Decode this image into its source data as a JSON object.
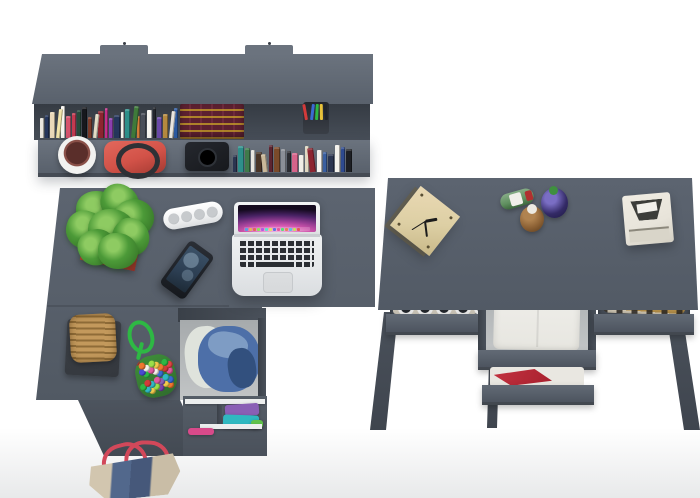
{
  "palette": {
    "background": "#ffffff",
    "floor_shadow": "#e8e9ea",
    "furniture": "#59616c",
    "furniture_light": "#6b737e",
    "furniture_dark": "#474e58",
    "drawer_front": "#5a626d",
    "leg": "#4a515b",
    "white_shelf": "#eceeee",
    "plant_green": "#4c9a38",
    "plant_green_dark": "#2f6b22",
    "planter_red": "#b53a2e",
    "pot_white": "#f2f2f0",
    "pot_plant": "#5a2e2a",
    "handbag_red": "#d25248",
    "handbag_strap": "#2e3136",
    "camera_black": "#17191d",
    "classic_book": "#5c2030",
    "classic_book_gold": "#c9a227",
    "laptop_body": "#e7e9eb",
    "laptop_key": "#2b2e33",
    "laptop_trackpad": "#d7d9db",
    "screen_dark": "#140a1e",
    "phone_body": "#15181d",
    "phone_screen": "#2c3e52",
    "speaker_white": "#f1f2f3",
    "basket_tan": "#c3995c",
    "basket_tan_dark": "#8f6c38",
    "tray_dark": "#34383e",
    "cord_green": "#2eb844",
    "denim_blue": "#4d6fa8",
    "denim_light": "#7e9cc4",
    "denim_dark": "#32507e",
    "cloth_white": "#dfe3dc",
    "clock_wood": "#ddcfa4",
    "bottle_green": "#5f8f5f",
    "bottle_amber": "#8a5f33",
    "bottle_blue": "#332a66",
    "white_box": "#e8e4da",
    "pants_white": "#efeeea",
    "red_cloth": "#a8202e",
    "plaid_tan": "#c0984e",
    "tote_beige": "#c9bda6",
    "tote_denim": "#52688c",
    "tote_strap_red": "#d2485a",
    "tee_black": "#1b1d21",
    "clothes_purple": "#8a5fb5",
    "clothes_teal": "#2fb8c0",
    "clothes_green": "#5fc14a",
    "clothes_pink": "#d84a8a"
  },
  "books": {
    "top_row": [
      "#e9e6df",
      "#25365c",
      "#ead9b9",
      "#f2e4a9",
      "#f7f5f0",
      "#d6536d",
      "#c23a50",
      "#274a3a",
      "#16181d",
      "#7a3b2a",
      "#e3dcc6",
      "#8c2430",
      "#c22f8a",
      "#8a3fae",
      "#25365c",
      "#f4f2ec",
      "#2e8f8a",
      "#3f7a3a",
      "#d07c3a",
      "#494e58",
      "#f7f5f0",
      "#23262c",
      "#6a49a8",
      "#b5893f",
      "#e9e6df",
      "#2c5aa0"
    ],
    "ledge_row": [
      "#2b3550",
      "#2e8f8a",
      "#3f7a4a",
      "#e8e6e0",
      "#4a3527",
      "#c9b89a",
      "#5c2430",
      "#7a4a2a",
      "#8a8f98",
      "#2b2d33",
      "#d6648a",
      "#f0ede6",
      "#e0d8c2",
      "#8c2430",
      "#f7f5f0",
      "#3a5fa0",
      "#2b3550",
      "#f4f2ec",
      "#2e4a8f",
      "#1d1f24"
    ]
  },
  "pens": [
    "#d23a3a",
    "#3a6bd2",
    "#2eb844",
    "#e8c23a",
    "#20242a"
  ],
  "pompoms": [
    "#e04444",
    "#3a6bd2",
    "#f2c94c",
    "#e05aa0",
    "#7a3fae",
    "#2eb844",
    "#f07830",
    "#f4f2ec",
    "#30b8c4",
    "#d23a3a",
    "#9adf4a",
    "#4a4ad2",
    "#f2c94c",
    "#e05aa0",
    "#2eb844",
    "#f07830",
    "#30b8c4",
    "#e04444",
    "#8a5fb5",
    "#f4f2ec",
    "#3a6bd2",
    "#f2c94c",
    "#d23a3a",
    "#2eb844",
    "#e05aa0",
    "#f07830",
    "#30b8c4",
    "#9adf4a"
  ],
  "dock_icons": [
    "#5aa0e8",
    "#e8b85a",
    "#e86a5a",
    "#8ae85a",
    "#b85ae8",
    "#5ae8d2",
    "#e8e85a",
    "#5a78e8",
    "#e85aa0",
    "#5ae87a",
    "#e8885a",
    "#5ac8e8",
    "#c8e85a",
    "#e85a5a"
  ],
  "objects": {
    "wall_shelf": "Wall shelf with books and accessories",
    "classic_books": "Antique red-and-gold book set",
    "pencil_cup": "Pencil cup",
    "flower_pot": "White flower pot",
    "handbag": "Red handbag",
    "black_camera": "Black camera",
    "left_desk": "Corner desk, top view",
    "potted_plant": "Green plant in red planter",
    "speaker": "White portable speaker",
    "smartphone": "Black smartphone",
    "laptop": "Open laptop, top view",
    "basket": "Wicker basket on tray",
    "cord_toy": "Green cord with bead pouch",
    "denim_drawer": "Open drawer with denim bag",
    "clothes_shelf": "Shelf with folded clothes",
    "tote_bag": "Canvas-and-denim tote bag",
    "right_desk": "Dressing table with open drawers",
    "cube_clock": "Plywood cube clock",
    "bottles": "Glass bottles",
    "white_box": "White instant camera box",
    "tee_drawer": "Drawer with graphic tee and rings",
    "pants_drawer": "Drawer with folded white trousers",
    "red_cloth_drawer": "Drawer with red cloth",
    "plaid_drawer": "Drawer with plaid shirt"
  }
}
